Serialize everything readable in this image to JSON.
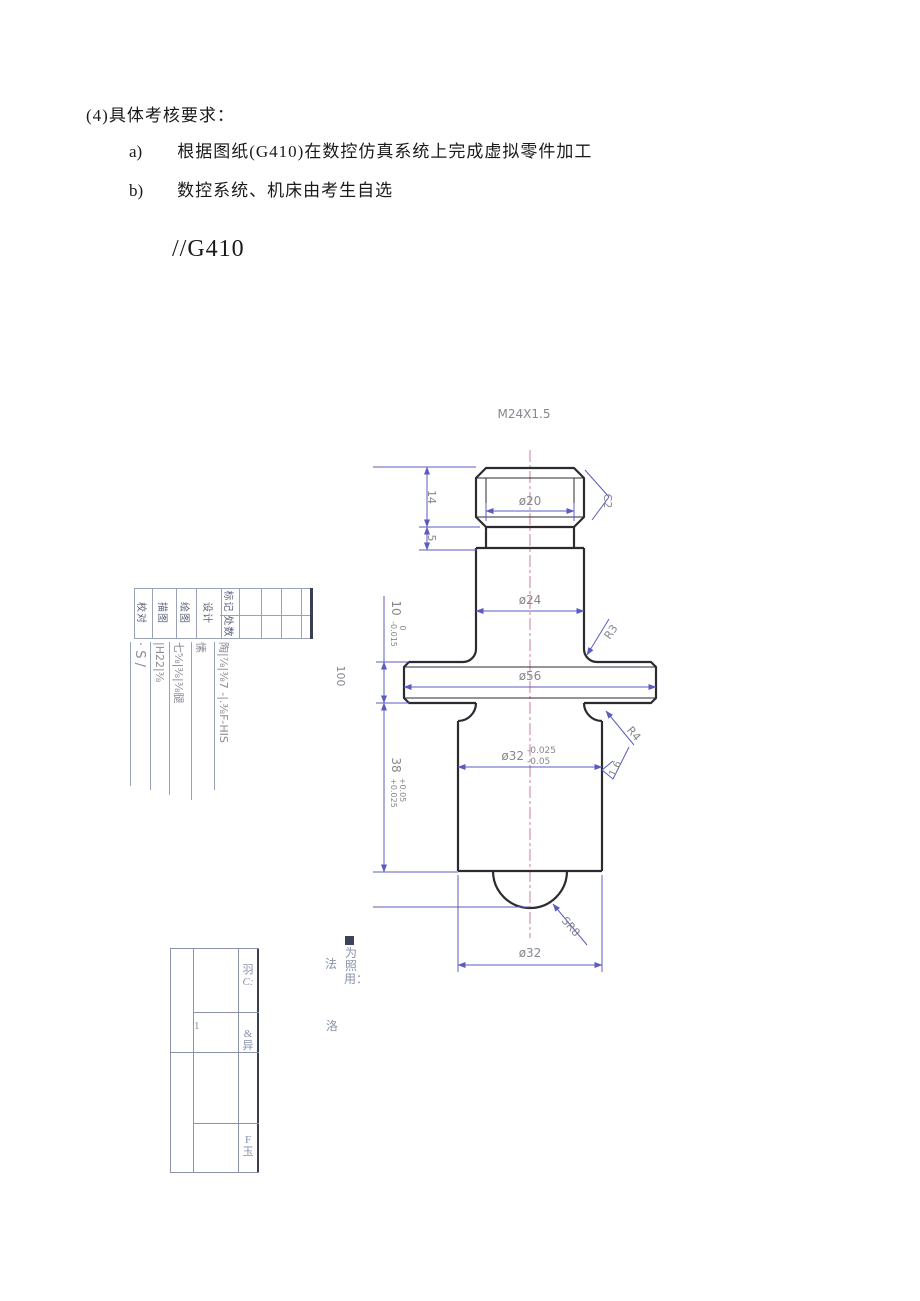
{
  "document": {
    "heading": "(4)具体考核要求：",
    "list": [
      {
        "marker": "a)",
        "text": "根据图纸(G410)在数控仿真系统上完成虚拟零件加工"
      },
      {
        "marker": "b)",
        "text": "数控系统、机床由考生自选"
      }
    ],
    "figure_code": "//G410"
  },
  "drawing": {
    "thread_label": "M24X1.5",
    "dims": {
      "dia20": "ø20",
      "dia24": "ø24",
      "dia56": "ø56",
      "dia32_main": "ø32",
      "dia32_upper": "-0.025",
      "dia32_lower": "-0.05",
      "dia32_bottom": "ø32",
      "len14": "14",
      "len5": "5",
      "len10_main": "10",
      "len10_upper": "0",
      "len10_lower": "-0.015",
      "len38_main": "38",
      "len38_upper": "+0.05",
      "len38_lower": "+0.025",
      "len100": "100",
      "chamfer": "C2",
      "fillet_r3": "R3",
      "fillet_r4": "R4",
      "sphere_radius": "SR8",
      "roughness": "1.6"
    },
    "title_block": {
      "header_left": "标记",
      "header_right": "处数",
      "rows": [
        {
          "label": "",
          "text": "陶|⅞|⅜7 -|.⅜F-HIS"
        },
        {
          "label": "设计",
          "text": "愫"
        },
        {
          "label": "绘图",
          "text": "七⅝|⅜|⅜腿"
        },
        {
          "label": "描图",
          "text": "|H22|⅜"
        },
        {
          "label": "校对",
          "text": "· S /"
        }
      ]
    }
  },
  "revision_table": {
    "c_top_a": "羽",
    "c_top_b": "C:",
    "qty": "1",
    "c_mid_a": "&",
    "c_mid_b": "异",
    "c_bot_a": "F",
    "c_bot_b": "玉"
  },
  "caption": {
    "vertical": "为照用：",
    "left_char": "法",
    "bottom_char": "洛"
  },
  "colors": {
    "outline": "#2b2b31",
    "dimension_line": "#5b5bc2",
    "dimension_text": "#86868f",
    "centerline": "#d4889a",
    "table_line": "#8a92ac",
    "body_text": "#1a1a1a"
  }
}
